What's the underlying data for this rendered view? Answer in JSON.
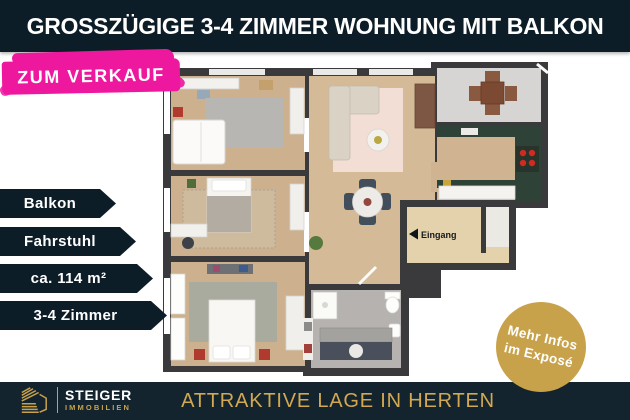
{
  "header": {
    "title": "GROSSZÜGIGE 3-4 ZIMMER WOHNUNG MIT BALKON"
  },
  "sale_badge": {
    "label": "ZUM VERKAUF"
  },
  "feature_banners": [
    {
      "label": "Balkon"
    },
    {
      "label": "Fahrstuhl"
    },
    {
      "label": "ca. 114 m²"
    },
    {
      "label": "3-4 Zimmer"
    }
  ],
  "floorplan": {
    "entrance_label": "Eingang"
  },
  "info_badge": {
    "line1": "Mehr Infos",
    "line2": "im Exposé"
  },
  "footer": {
    "brand_name": "STEIGER",
    "brand_subtitle": "IMMOBILIEN",
    "tagline": "ATTRAKTIVE LAGE IN HERTEN"
  },
  "colors": {
    "accent_pink": "#ee189f",
    "accent_gold": "#c8a24b",
    "dark_navy": "#0d1d28",
    "footer_navy": "#13242f",
    "wall_gray": "#3a3a3c"
  }
}
